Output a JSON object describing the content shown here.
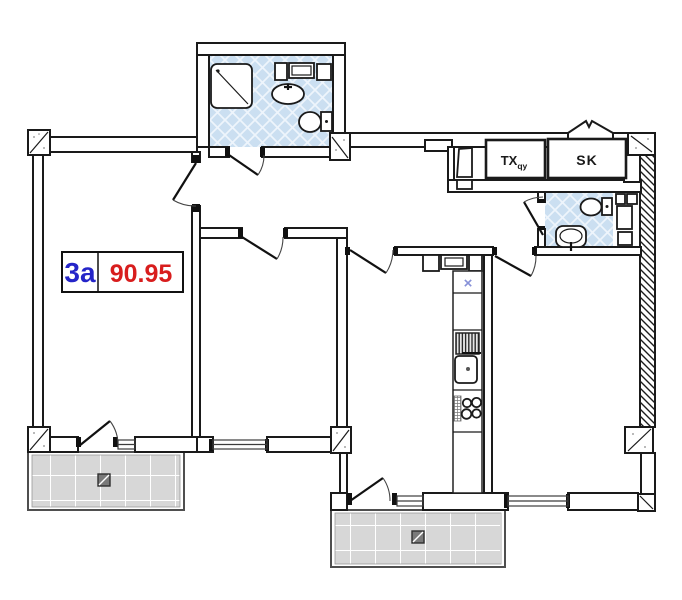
{
  "plan": {
    "unit": {
      "code": "3a",
      "area": "90.95"
    },
    "shafts": {
      "tx_main": "TX",
      "tx_sub": "qy",
      "sk": "SK"
    },
    "kitchen": {
      "vent_mark": "×"
    },
    "colors": {
      "wall": "#1a1a1a",
      "bath_floor": "#cbdff1",
      "balcony_floor": "#d7d7d7",
      "unit_code_color": "#2424c8",
      "unit_area_color": "#d81d1d",
      "vent_mark_color": "#8791d8"
    }
  }
}
